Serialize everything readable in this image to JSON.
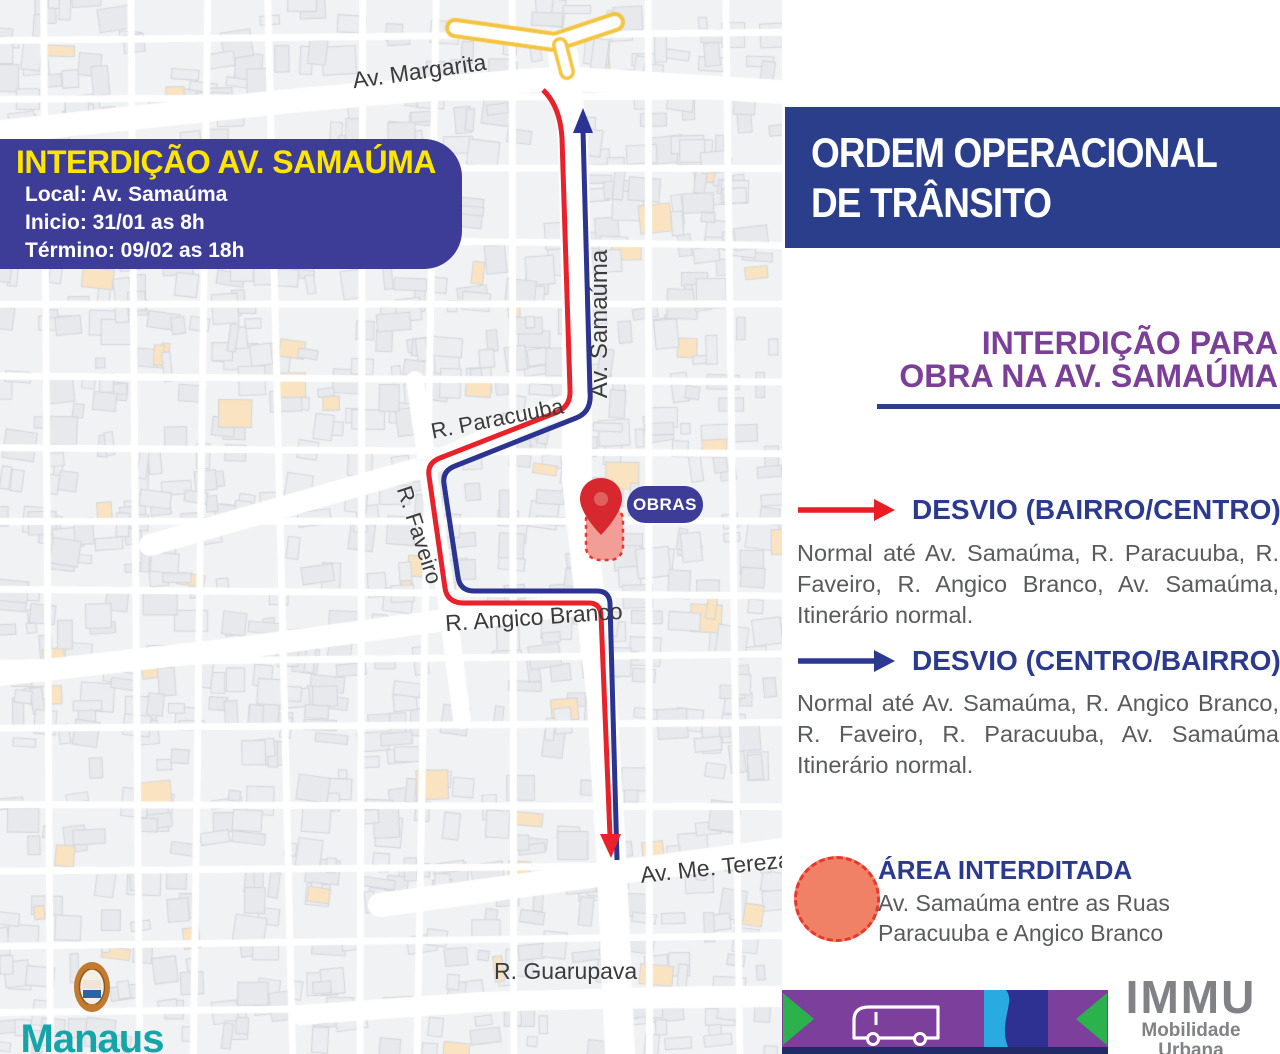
{
  "map": {
    "info_box": {
      "title": "INTERDIÇÃO AV. SAMAÚMA",
      "line1": "Local: Av. Samaúma",
      "line2": "Inicio: 31/01 as 8h",
      "line3": "Término: 09/02 as 18h"
    },
    "labels": {
      "margarita": "Av. Margarita",
      "samauma": "Av. Samaúma",
      "paracuuba": "R. Paracuuba",
      "faveiro": "R. Faveiro",
      "angico": "R. Angico Branco",
      "tereza": "Av. Me. Tereza",
      "guarupava": "R. Guarupava"
    },
    "obras_badge": "OBRAS",
    "logo": {
      "city": "Manaus",
      "subtitle": "Prefeitura Municipal"
    }
  },
  "panel": {
    "header": {
      "line1": "ORDEM OPERACIONAL",
      "line2": "DE TRÂNSITO"
    },
    "subtitle": {
      "line1": "INTERDIÇÃO PARA",
      "line2": "OBRA NA AV. SAMAÚMA"
    },
    "desvio_bairro_centro": {
      "title": "DESVIO (BAIRRO/CENTRO)",
      "body": "Normal até Av. Samaúma, R. Paracuuba, R. Faveiro, R. Angico Branco, Av. Samaúma, Itinerário normal."
    },
    "desvio_centro_bairro": {
      "title": "DESVIO (CENTRO/BAIRRO)",
      "body": "Normal até Av. Samaúma, R. Angico Branco, R. Faveiro, R. Paracuuba, Av. Samaúma Itinerário normal."
    },
    "legend": {
      "title": "ÁREA INTERDITADA",
      "body": "Av. Samaúma entre as Ruas Paracuuba e Angico Branco"
    }
  },
  "footer": {
    "logo_title": "IMMU",
    "logo_subtitle": "Mobilidade Urbana"
  },
  "colors": {
    "indigo_box": "#3D3C96",
    "header_navy": "#2B3E8C",
    "purple_heading": "#7B3F97",
    "desvio_blue": "#2B3A8F",
    "route_red": "#E8212A",
    "route_blue": "#2B3490",
    "body_gray": "#595A5C",
    "area_fill": "#F08166",
    "area_border": "#E8372D",
    "footer_purple": "#7C3F9B",
    "footer_green": "#2BB24C",
    "footer_lightblue": "#29ABE2",
    "footer_navy": "#2E3192",
    "manaus_teal": "#14A5A8",
    "immu_gray": "#808285"
  }
}
